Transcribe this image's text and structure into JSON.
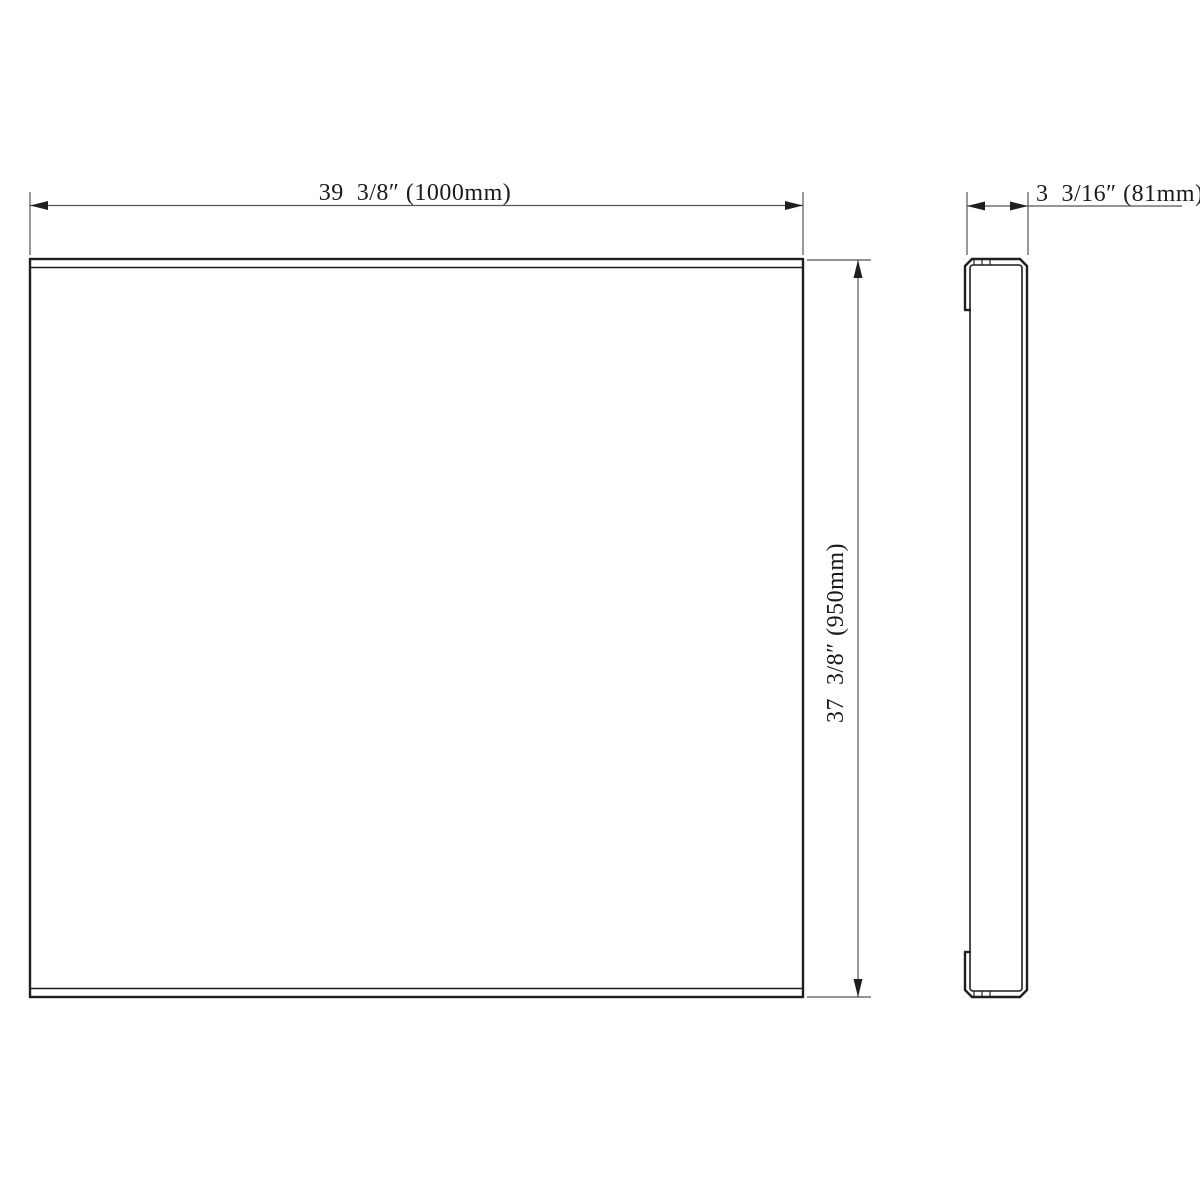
{
  "drawing": {
    "description_labels": {
      "width_label": "39  3/8″ (1000mm)",
      "height_label": "37  3/8″ (950mm)",
      "depth_label": "3  3/16″ (81mm)"
    },
    "dimensions": {
      "width": {
        "inches": "39 3/8″",
        "millimeters": "1000mm"
      },
      "height": {
        "inches": "37 3/8″",
        "millimeters": "950mm"
      },
      "depth": {
        "inches": "3 3/16″",
        "millimeters": "81mm"
      }
    }
  },
  "colors": {
    "line_color": "#1f1f1f",
    "dim_color": "#555555",
    "text_color": "#1a1a1a",
    "bg_color": "#ffffff"
  }
}
